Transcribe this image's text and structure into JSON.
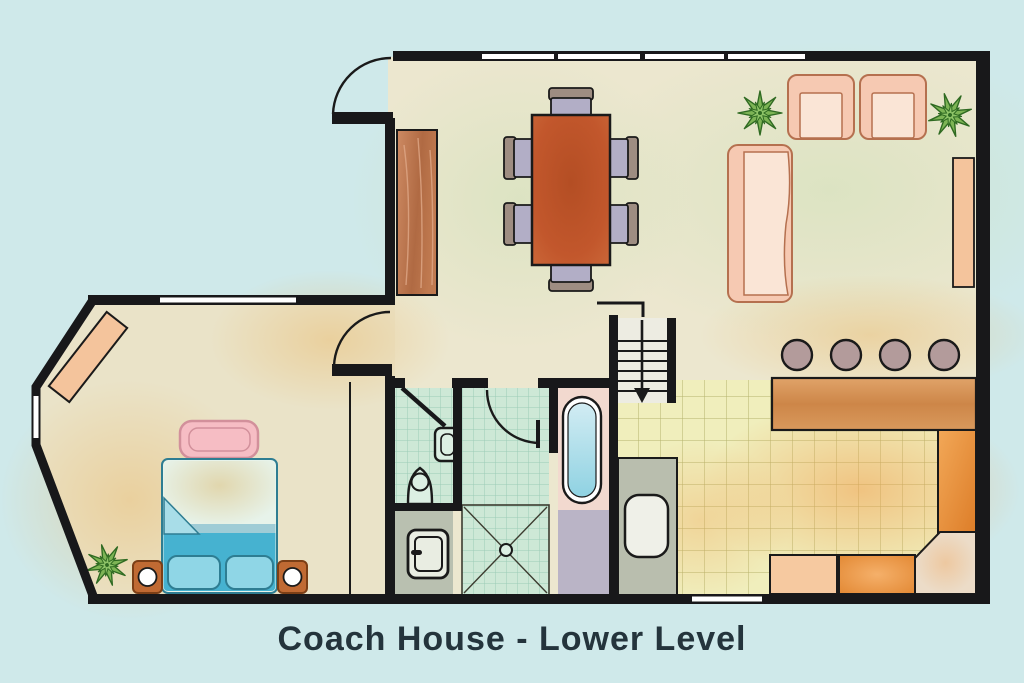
{
  "title": "Coach House - Lower Level",
  "plan": {
    "name": "Coach House",
    "level": "Lower Level",
    "rooms": [
      "entry",
      "dining-area",
      "living-room",
      "bedroom",
      "closet",
      "bathroom",
      "shower-room",
      "laundry",
      "kitchen",
      "breakfast-bar",
      "stairwell"
    ],
    "furniture_counts": {
      "dining_chairs": 6,
      "dining_tables": 1,
      "sofas": 1,
      "armchairs": 2,
      "plants": 3,
      "beds": 1,
      "pillows": 2,
      "nightstands": 2,
      "benches": 1,
      "dressers": 1,
      "bar_stools": 4,
      "bathtubs": 1,
      "showers": 1,
      "toilets": 1,
      "sinks": 2,
      "washers": 1,
      "top_wall_windows": 4
    }
  },
  "colors": {
    "background": "#cfe9ea",
    "wall": "#18181a",
    "window": "#ffffff",
    "floor_main": "#ece7cf",
    "floor_bedroom": "#eae3c8",
    "kitchen_tile": "#f0eebc",
    "kitchen_tile_line": "#9a9a4a",
    "bath_tile": "#cde8d6",
    "bath_tile_line": "#8ec4ae",
    "laundry_floor": "#b9c0b0",
    "tub_surround": "#f2d9cf",
    "tub_water": "#8fd2e2",
    "under_tub_floor": "#bab4c6",
    "utility_counter": "#b9beae",
    "wood_counter": "#d5945b",
    "wood_console": "#c0734e",
    "dining_table": "#c2572c",
    "chair_seat": "#b2aec6",
    "chair_back": "#9e8d82",
    "sofa_body": "#f6c9b2",
    "sofa_cushion": "#fae5d6",
    "shelf": "#f4c49c",
    "bed_base": "#46b2d0",
    "bed_duvet": "#e7f3ea",
    "bed_pillow": "#8fd6e6",
    "bench_pink": "#f6bdc4",
    "nightstand": "#c06a33",
    "plant_green": "#7db455",
    "stool": "#b39b9b",
    "counter_orange": "#e8913c",
    "counter_peach": "#f6c9a0",
    "title_text": "#24343c"
  }
}
